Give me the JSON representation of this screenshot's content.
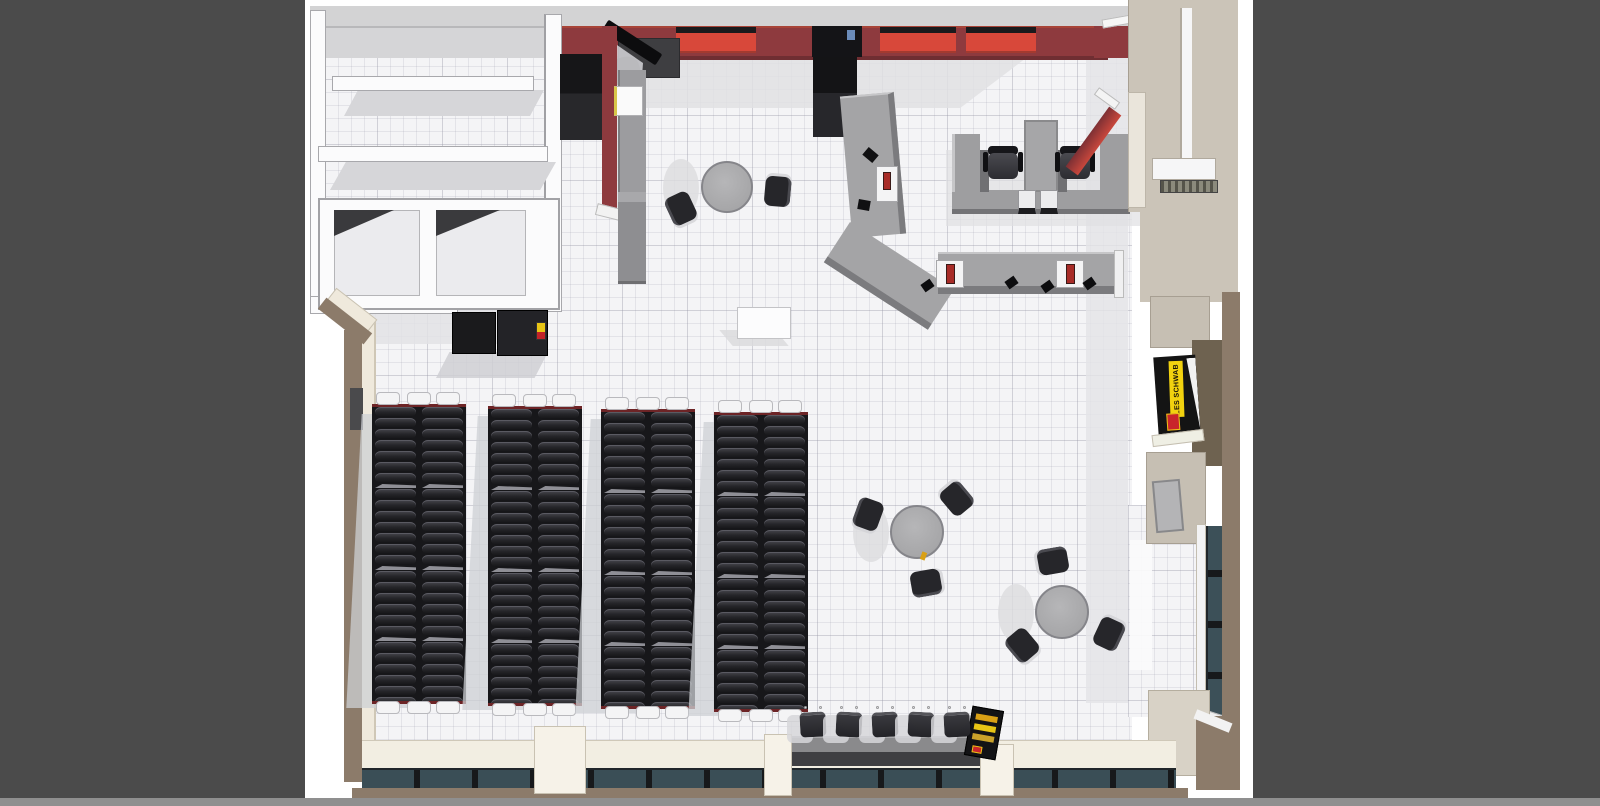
{
  "scene": {
    "description": "Top-down 3D architectural render of a tire store interior floor plan",
    "view_label": "plan view render",
    "sign": {
      "brand_text": "LES SCHWAB",
      "panel_color": "#141414",
      "banner_color": "#f2d20f",
      "logo_box_color": "#c9242b"
    },
    "palette": {
      "backdrop_gray": "#4b4b4b",
      "canvas_white": "#ffffff",
      "bottom_strip": "#8f8f8f",
      "floor_tile": "#f4f4f6",
      "floor_shadow": "#e0e0e4",
      "wall_red": "#8e3a3e",
      "bay_red_bright": "#d8483a",
      "roof_gray": "#d3d3d4",
      "counter_gray": "#a4a4a6",
      "counter_side_gray": "#7b7b7e",
      "right_wall_tan": "#cbc4b8",
      "outer_wall_brown": "#8c7b6a",
      "window_glass": "#3c5058",
      "window_mullion": "#17191b",
      "tire_black": "#28282a",
      "furniture_black": "#2a2a2d",
      "table_gray": "#a9a9ab",
      "cream_wall": "#efe9dc"
    },
    "fixtures": {
      "tire_racks": {
        "count": 4,
        "columns_per_rack": 2,
        "tire_rows_per_column": 26,
        "sections_per_rack": 4
      },
      "round_tables": [
        {
          "name": "cafe-table-top",
          "chairs": 2
        },
        {
          "name": "cafe-table-mid",
          "chairs": 3
        },
        {
          "name": "cafe-table-right",
          "chairs": 3
        }
      ],
      "waiting_chairs": {
        "count": 5
      },
      "sales_desk": {
        "office_chairs": 2,
        "terminals": 2
      },
      "checkout_registers": {
        "count": 4
      },
      "red_wall_bays": {
        "count": 3
      },
      "storage_shelves": {
        "count": 3
      }
    }
  }
}
